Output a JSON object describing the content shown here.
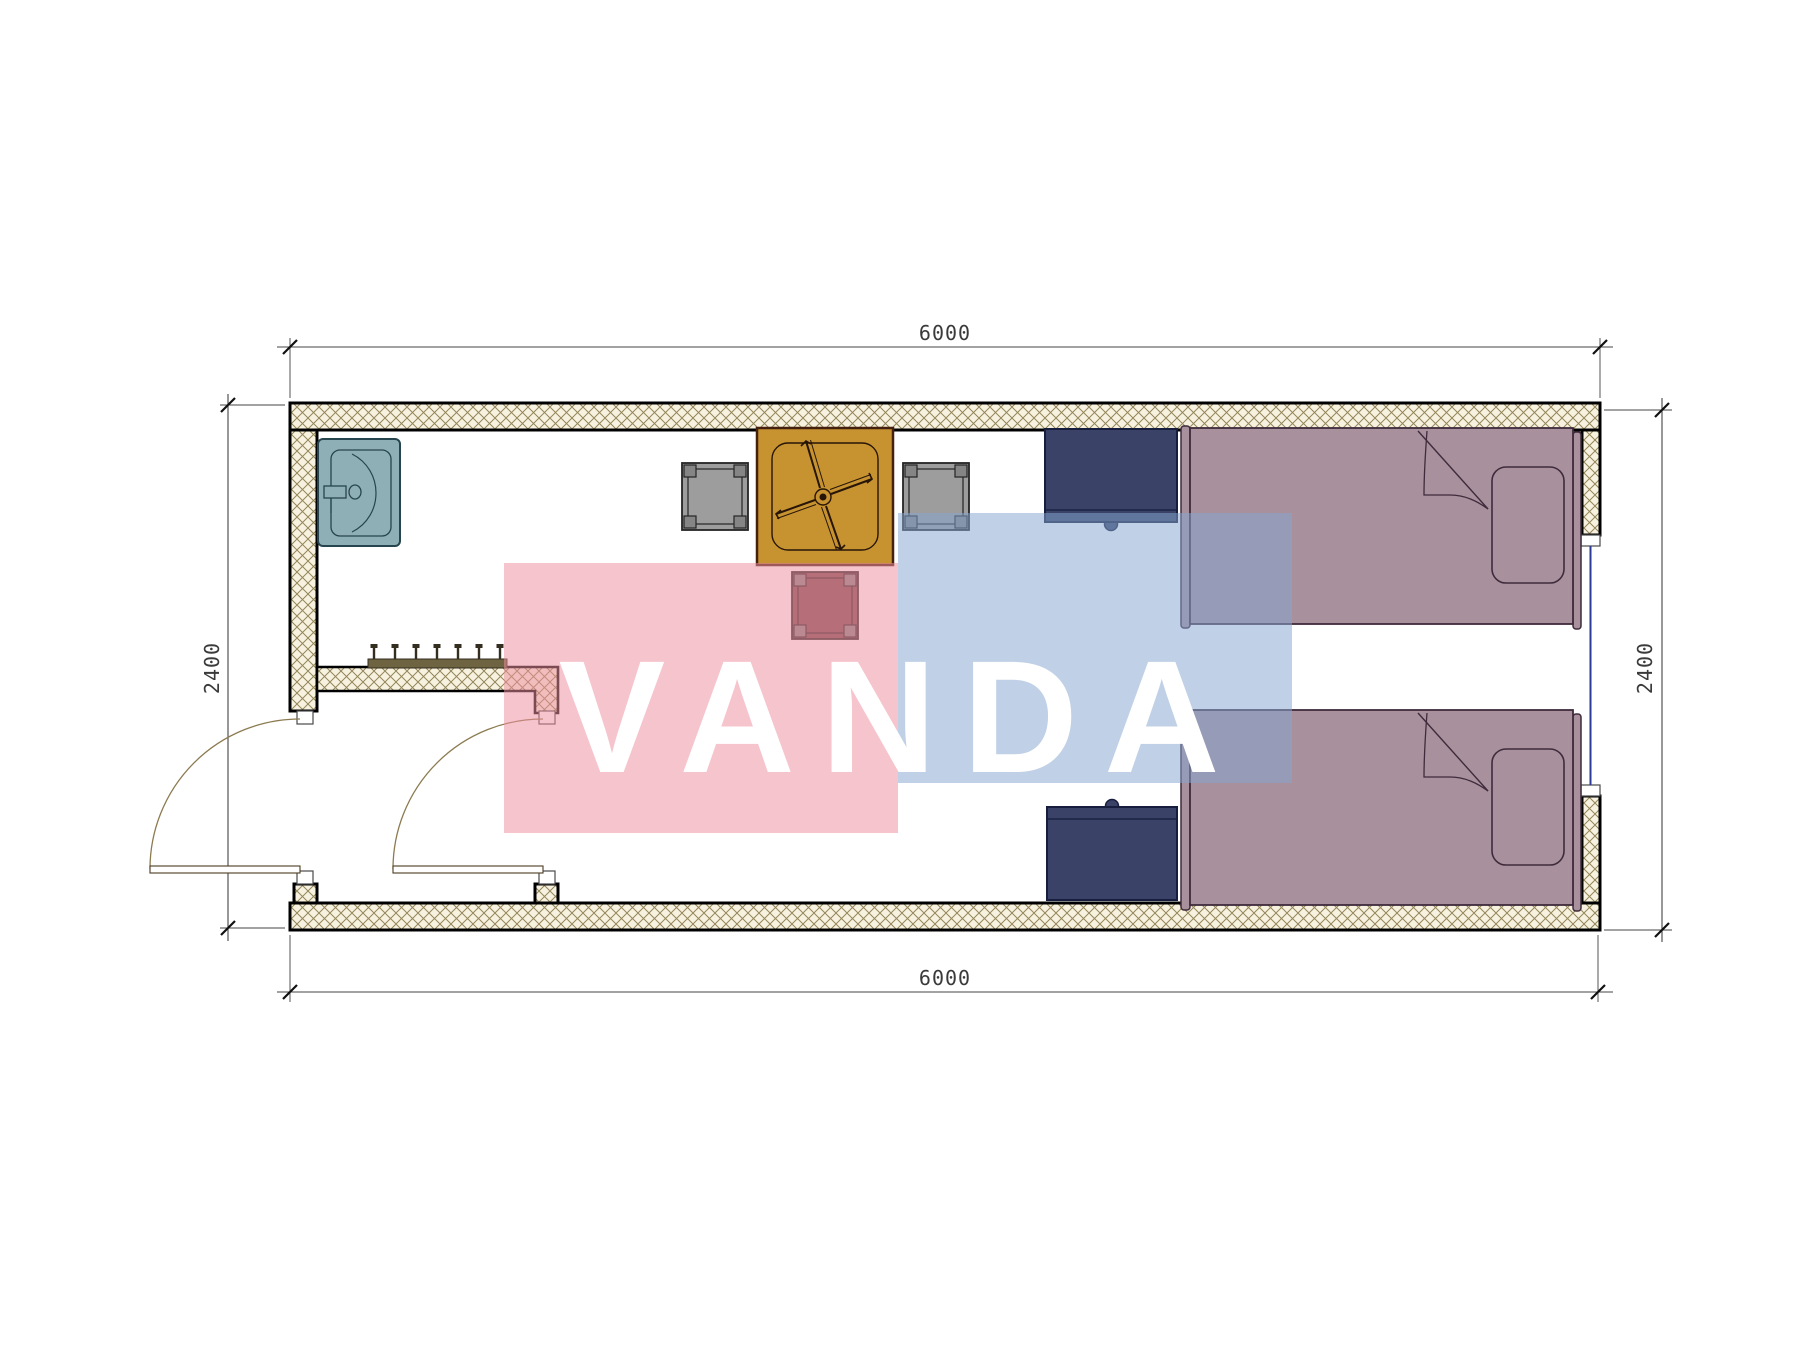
{
  "document": {
    "type": "architectural floor plan",
    "description": "container room plan with sink, entry hall with coat rack, table with ceiling fan symbol, three stools, two nightstands and two single beds"
  },
  "watermark": {
    "text": "VANDA"
  },
  "dimensions": {
    "top": {
      "value": "6000"
    },
    "bottom": {
      "value": "6000"
    },
    "left": {
      "value": "2400"
    },
    "right": {
      "value": "2400"
    }
  },
  "furniture": {
    "sink": "sink",
    "coat_rack": "coat rack with 7 hooks",
    "table": "square table with ceiling fan symbol",
    "stools": [
      "stool-left",
      "stool-right",
      "stool-bottom"
    ],
    "nightstands": [
      "nightstand-top",
      "nightstand-bottom"
    ],
    "beds": [
      "single-bed-top",
      "single-bed-bottom"
    ],
    "doors": [
      "entry-door-left",
      "entry-door-right"
    ],
    "window": "window-right-wall"
  },
  "colors": {
    "wallFill": "#f7f2df",
    "hatchLine": "#94865a",
    "wallEdge": "#000000",
    "sink": "#8fafb6",
    "sinkLine": "#27454e",
    "rackBar": "#6e6442",
    "rackHook": "#332e1f",
    "table": "#c79331",
    "tableLine": "#46200f",
    "tableInner": "#271507",
    "stool": "#9d9d9d",
    "stoolCorner": "#858585",
    "stoolLine": "#252525",
    "stool3": "#7a4d52",
    "nightstand": "#3a4367",
    "nightstandLine": "#161d3d",
    "bed": "#a8919d",
    "bedLine": "#3f2b3c",
    "window": "#2b3a96",
    "doorArc": "#8c7b50",
    "doorLeaf": "#4a3b20",
    "dimLine": "#444444",
    "tick": "#111111",
    "wmPink": "#ee8d9e",
    "wmBlue": "#86a4cf",
    "wmText": "#ffffff"
  }
}
